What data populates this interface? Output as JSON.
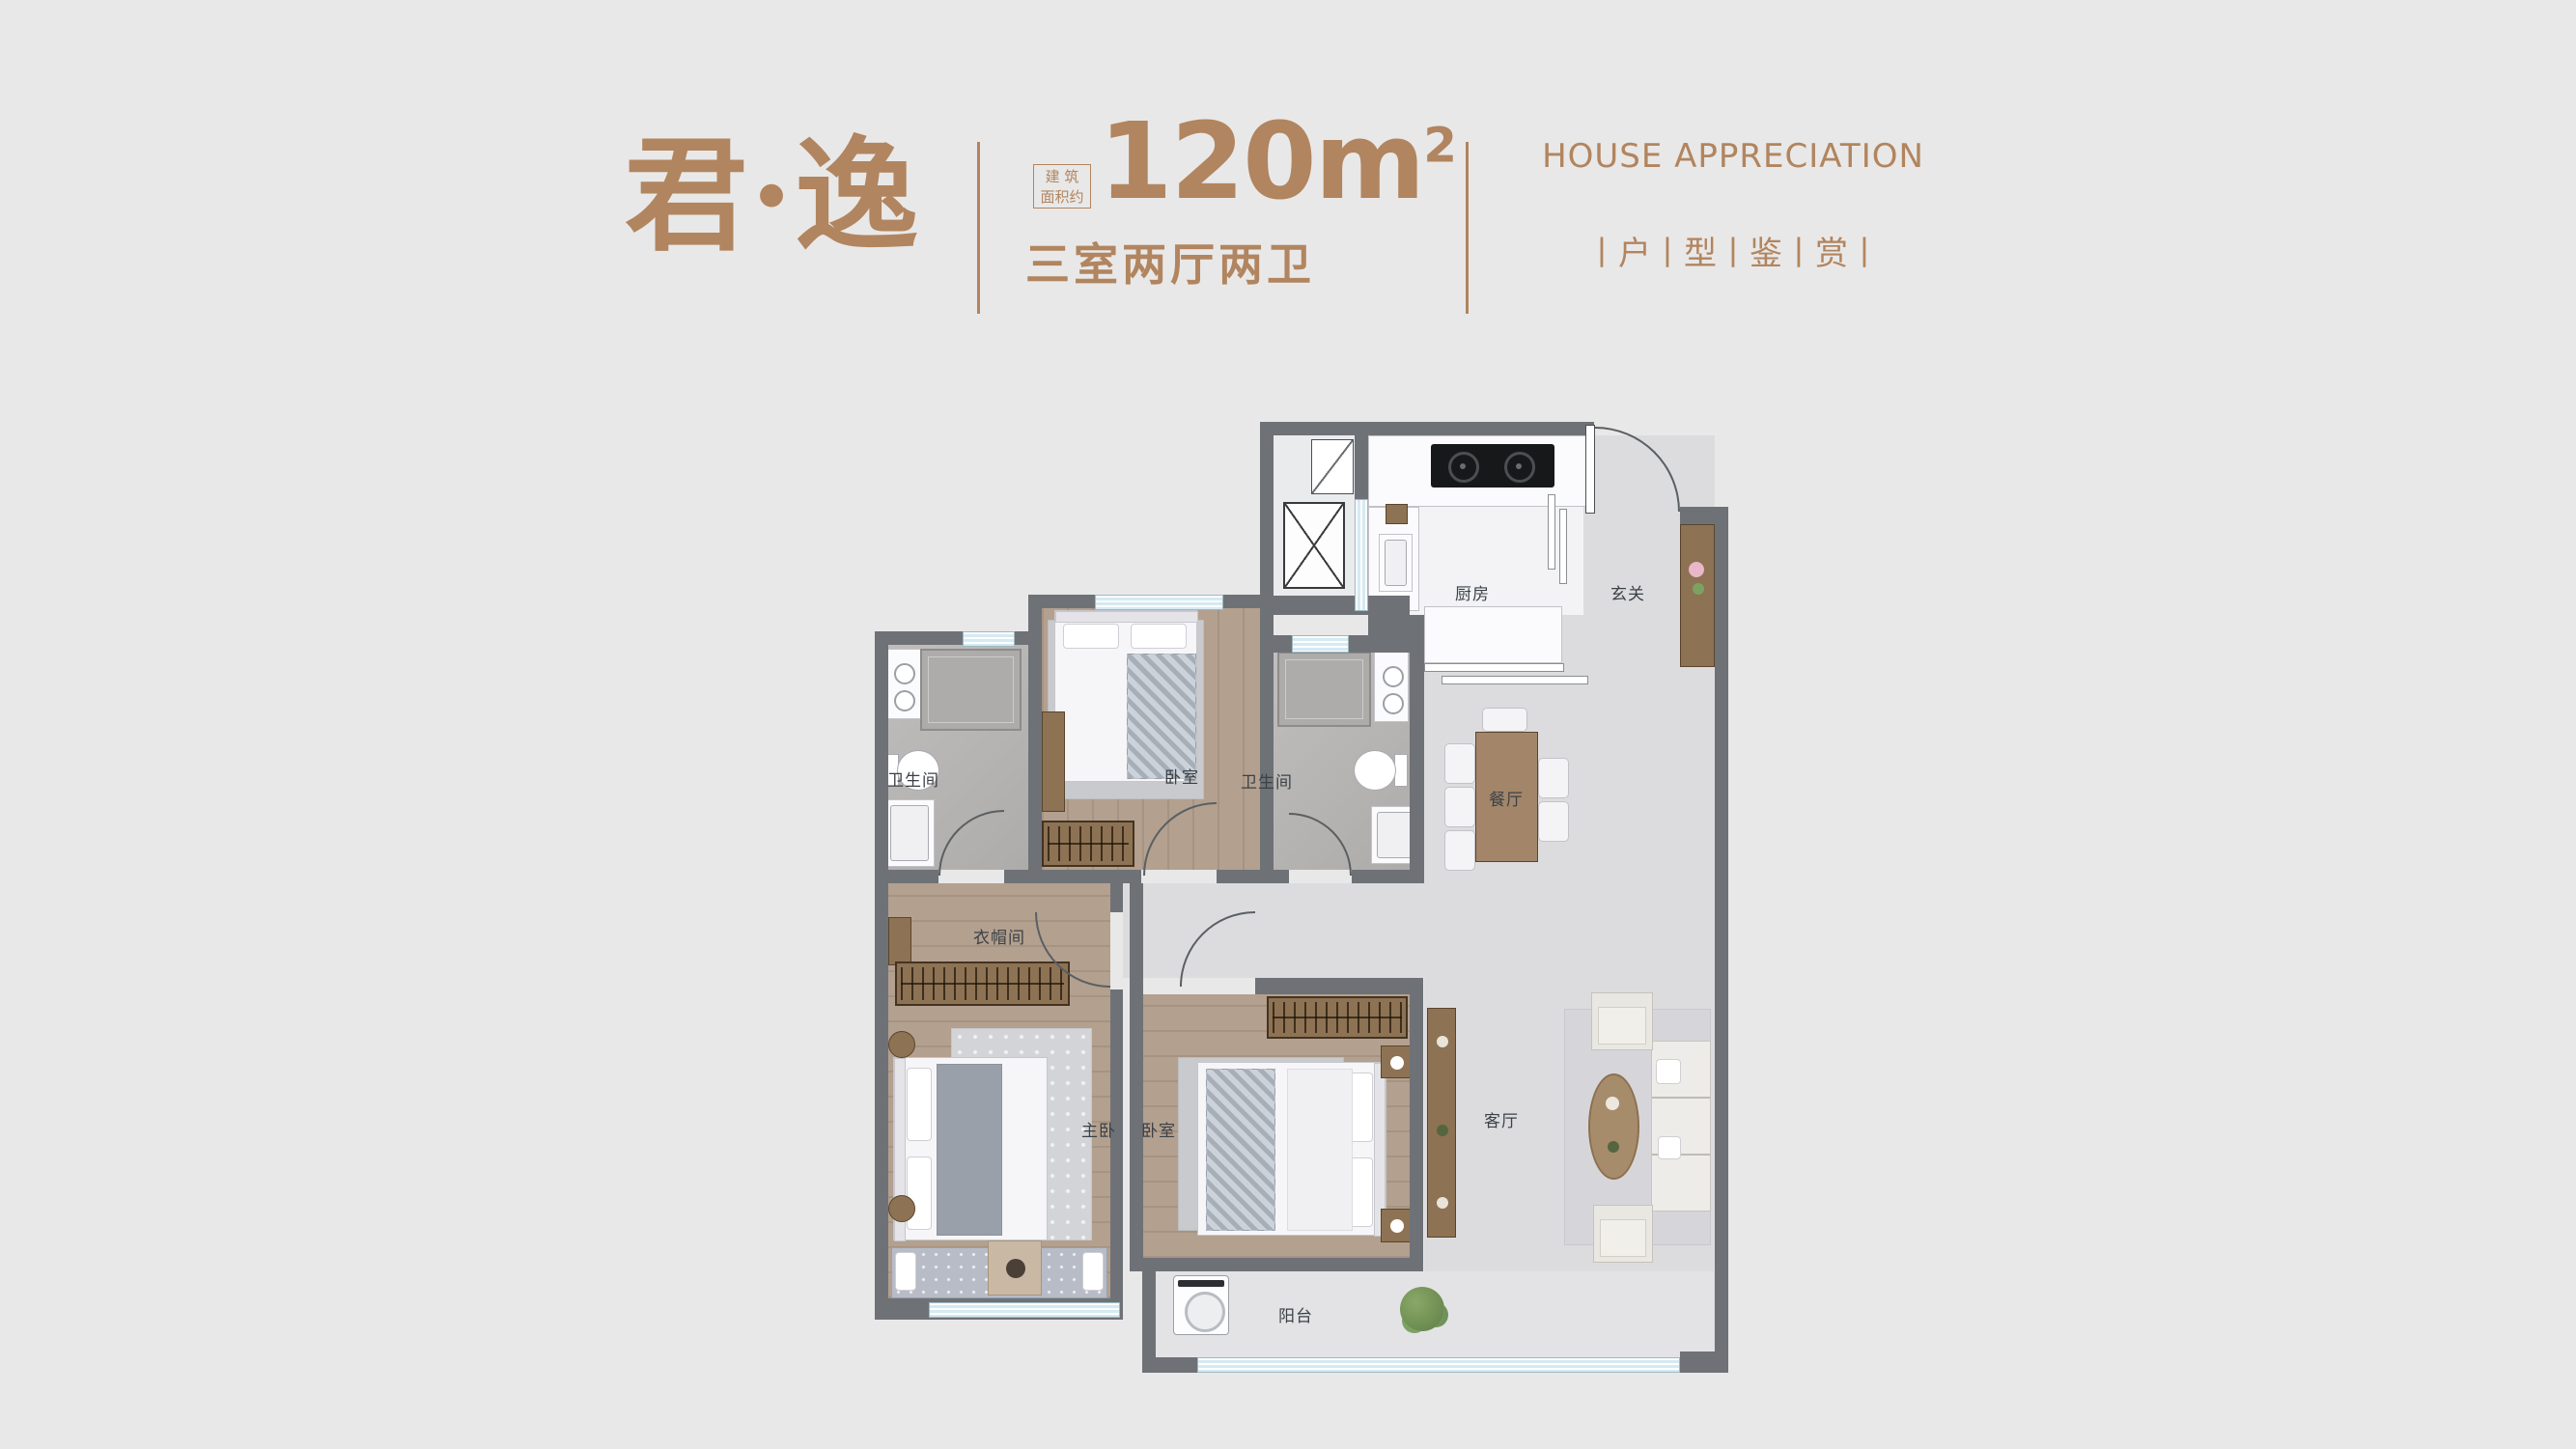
{
  "header": {
    "title": "君·逸",
    "area_badge_line1": "建 筑",
    "area_badge_line2": "面积约",
    "area_value": "120m",
    "area_sup": "2",
    "layout_text": "三室两厅两卫",
    "subtitle_en": "HOUSE APPRECIATION",
    "subtitle_cn": "丨户丨型丨鉴丨赏丨"
  },
  "floorplan": {
    "labels": {
      "kitchen": "厨房",
      "foyer": "玄关",
      "dining": "餐厅",
      "living": "客厅",
      "balcony": "阳台",
      "master_bedroom": "主卧",
      "bedroom_bottom": "卧室",
      "bedroom_top": "卧室",
      "bath_left": "卫生间",
      "bath_right": "卫生间",
      "closet": "衣帽间"
    }
  },
  "colors": {
    "accent": "#b1855f",
    "wall": "#6e7277",
    "window_blue": "#d5eaf2",
    "wood_floor": "#b3a08f",
    "marble_floor": "#dcdcdf",
    "background": "#e9e8e8"
  }
}
